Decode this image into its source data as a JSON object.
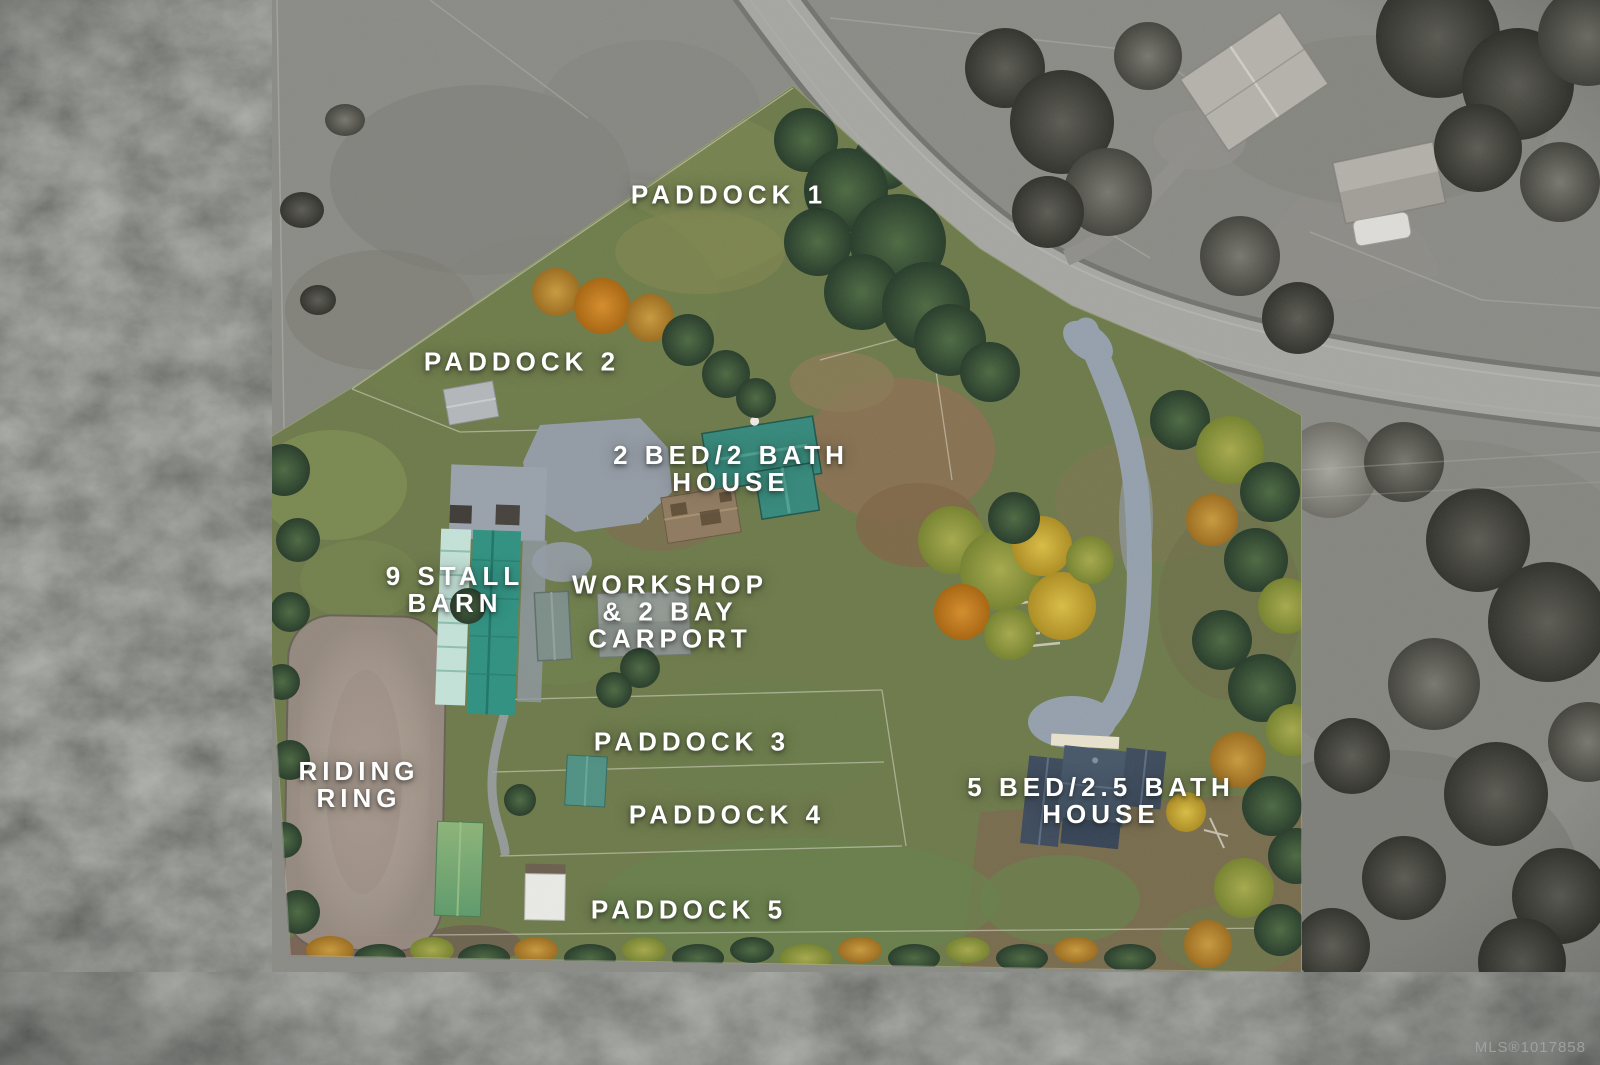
{
  "labels": {
    "paddock1": {
      "line1": "PADDOCK 1"
    },
    "paddock2": {
      "line1": "PADDOCK 2"
    },
    "house2": {
      "line1": "2 BED/2 BATH",
      "line2": "HOUSE"
    },
    "barn": {
      "line1": "9 STALL",
      "line2": "BARN"
    },
    "workshop": {
      "line1": "WORKSHOP",
      "line2": "& 2 BAY",
      "line3": "CARPORT"
    },
    "paddock3": {
      "line1": "PADDOCK 3"
    },
    "paddock4": {
      "line1": "PADDOCK 4"
    },
    "riding": {
      "line1": "RIDING",
      "line2": "RING"
    },
    "paddock5": {
      "line1": "PADDOCK 5"
    },
    "house5": {
      "line1": "5 BED/2.5 BATH",
      "line2": "HOUSE"
    }
  },
  "watermark": {
    "text": "MLS®1017858"
  },
  "colors": {
    "label_text": "#ffffff",
    "watermark_gray": "#a6a6a6",
    "grass_olive": "#6d7a4a",
    "dirt_brown": "#8a7052",
    "riding_ring_sand": "#ab9d93",
    "barn_roof_teal": "#2f9181",
    "barn_roof_mint": "#c4e2d8",
    "house2_roof_teal": "#35897b",
    "house5_roof_slate": "#465769",
    "driveway_gravel": "#95a0ad",
    "road_asphalt": "#a6a6a2",
    "surround_gray_field": "#8e8e89",
    "forest_dark": "#3a3d38",
    "autumn_yellow": "#d4b83f",
    "autumn_orange": "#cf8626"
  }
}
